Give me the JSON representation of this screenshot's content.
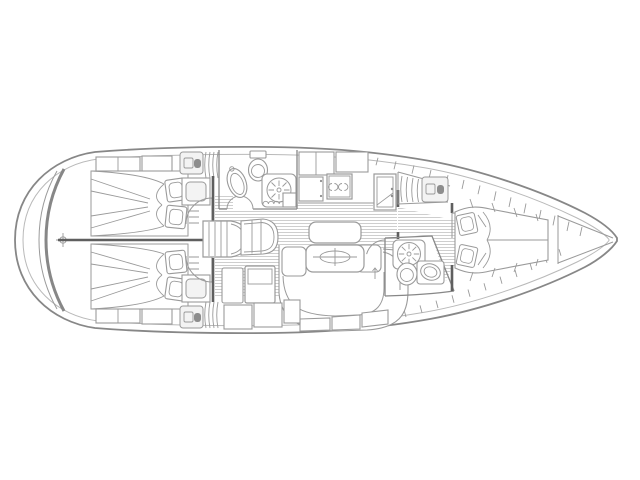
{
  "page": {
    "background": "#ffffff"
  },
  "palette": {
    "background": "#ffffff",
    "line": "#9a9a9a",
    "line_strong": "#878787",
    "line_light": "#b9b9b9",
    "bulkhead": "#5f5f5f",
    "hatch": "#c9c9c9",
    "panel": "#f3f3f3",
    "icon": "#8d8d8d"
  },
  "diagram": {
    "kind": "sailing-yacht-interior-floor-plan",
    "orientation": {
      "bow": "right",
      "stern": "left"
    },
    "areas": [
      {
        "id": "stern",
        "name": "stern transom with datum crosshair"
      },
      {
        "id": "aft-cabin-upper",
        "name": "upper aft double cabin with berth and pillows"
      },
      {
        "id": "aft-cabin-lower",
        "name": "lower aft double cabin with berth and pillows"
      },
      {
        "id": "companionway",
        "name": "companionway steps and seat"
      },
      {
        "id": "aft-head",
        "name": "aft head with basin, toilet and shower"
      },
      {
        "id": "galley",
        "name": "galley with two-burner stove and lockers"
      },
      {
        "id": "salon",
        "name": "salon with folding table and U-shaped settee"
      },
      {
        "id": "nav-station",
        "name": "navigation station with chart table"
      },
      {
        "id": "forward-head",
        "name": "forward head with shower, toilet and basin"
      },
      {
        "id": "v-berth",
        "name": "forward V-berth cabin with shelves"
      },
      {
        "id": "bow",
        "name": "bow anchor locker"
      }
    ]
  }
}
